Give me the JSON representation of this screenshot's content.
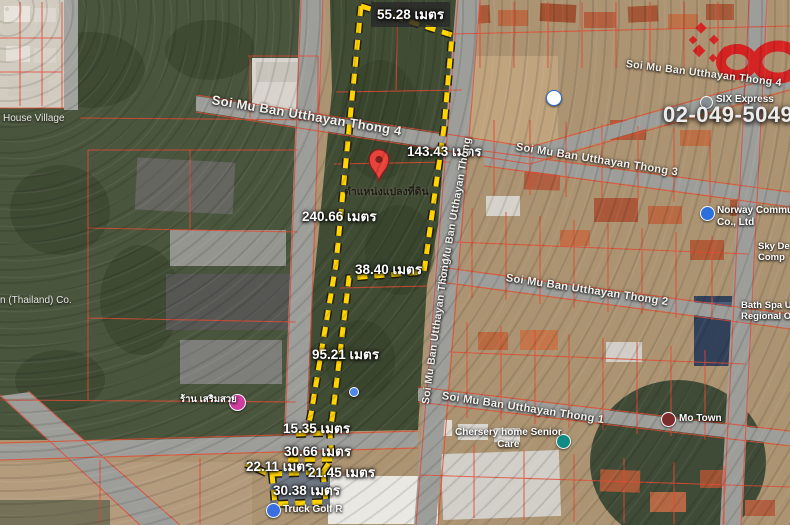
{
  "unit_note": "เมตร",
  "measurements": [
    {
      "label": "55.28 เมตร"
    },
    {
      "label": "143.43 เมตร"
    },
    {
      "label": "240.66 เมตร"
    },
    {
      "label": "38.40 เมตร"
    },
    {
      "label": "95.21 เมตร"
    },
    {
      "label": "15.35 เมตร"
    },
    {
      "label": "30.66 เมตร"
    },
    {
      "label": "22.11 เมตร"
    },
    {
      "label": "21.45 เมตร"
    },
    {
      "label": "30.38 เมตร"
    }
  ],
  "streets": [
    {
      "label": "Soi Mu Ban Utthayan Thong 4"
    },
    {
      "label": "Soi Mu Ban Utthayan Thong 4"
    },
    {
      "label": "Soi Mu Ban Utthayan Thong 3"
    },
    {
      "label": "Soi Mu Ban Utthayan Thong 2"
    },
    {
      "label": "Soi Mu Ban Utthayan Thong 1"
    },
    {
      "label": "Soi Mu Ban Utthayan Thong"
    },
    {
      "label": "Soi Mu Ban Utthayan Thong"
    }
  ],
  "pois": {
    "norway": {
      "line1": "Norway Communication",
      "line2": "Co., Ltd"
    },
    "sky": {
      "line1": "Sky De",
      "line2": "Comp"
    },
    "bathspa": {
      "line1": "Bath Spa Universi",
      "line2": "Regional Offi"
    },
    "motown": {
      "label": "Mo Town"
    },
    "chersery": {
      "line1": "Chersery home Senior",
      "line2": "Care"
    },
    "six": {
      "label": "SIX Express"
    },
    "truck": {
      "label": "Truck Golf R"
    },
    "salon": {
      "label": "ร้าน เสริมสวย"
    }
  },
  "places": {
    "house_village": "House Village",
    "thailand_co": "n (Thailand) Co."
  },
  "pin": {
    "label": "ตำแหน่งแปลงที่ดิน"
  },
  "contact": {
    "phone": "02-049-5049"
  },
  "icons": {
    "pin": "map-pin",
    "poi": "poi-dot",
    "logo": "infinity-logo"
  },
  "colors": {
    "boundary": "#ffd400",
    "cadastral_grid": "#e14b36",
    "logo_red": "#d71f1f",
    "pin_red": "#e8433a"
  }
}
